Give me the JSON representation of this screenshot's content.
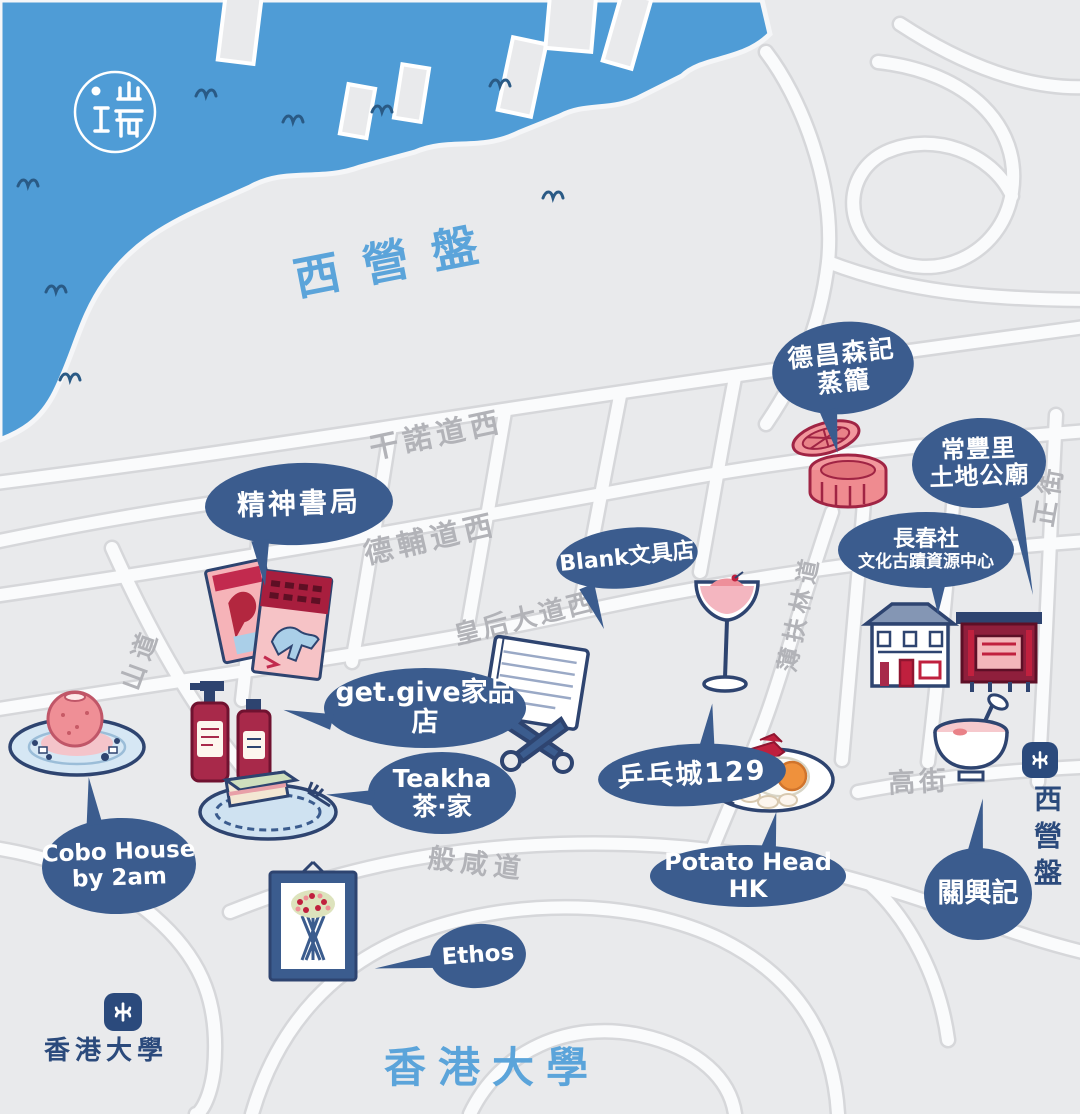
{
  "logo": {
    "glyph": "瑞"
  },
  "titles": {
    "region": "西營盤",
    "bottom": "香港大學"
  },
  "streets": {
    "connaught": "干諾道西",
    "desvoeux": "德輔道西",
    "queens": "皇后大道西",
    "bonham": "般咸道",
    "hill": "山道",
    "pokfulam": "薄扶林道",
    "high": "高街",
    "centre": "正街"
  },
  "places": {
    "spirit": {
      "line1": "精神書局"
    },
    "tuckchong": {
      "line1": "德昌森記",
      "line2": "蒸籠"
    },
    "earthgod": {
      "line1": "常豐里",
      "line2": "土地公廟"
    },
    "cache": {
      "line1": "長春社",
      "line2": "文化古蹟資源中心"
    },
    "blank": {
      "line1": "Blank文具店"
    },
    "getgive": {
      "line1": "get.give家品店"
    },
    "teakha": {
      "line1": "Teakha",
      "line2": "茶·家"
    },
    "pingpong": {
      "line1": "乒乓城129"
    },
    "potatohead": {
      "line1": "Potato Head HK"
    },
    "cobo": {
      "line1": "Cobo House",
      "line2": "by 2am"
    },
    "ethos": {
      "line1": "Ethos"
    },
    "kwanhing": {
      "line1": "關興記"
    }
  },
  "mtr": {
    "hku": "香港大學",
    "syp": "西營盤"
  },
  "colors": {
    "water": "#4f9cd6",
    "wave": "#2a5a85",
    "bubble": "#3b5c8e",
    "outline_navy": "#2e4470",
    "accent_red": "#a8294a",
    "pink": "#f2989d",
    "title_blue": "#5ba4da",
    "street_gray": "#b2b3b8",
    "mtr_navy": "#2b4a7c"
  }
}
